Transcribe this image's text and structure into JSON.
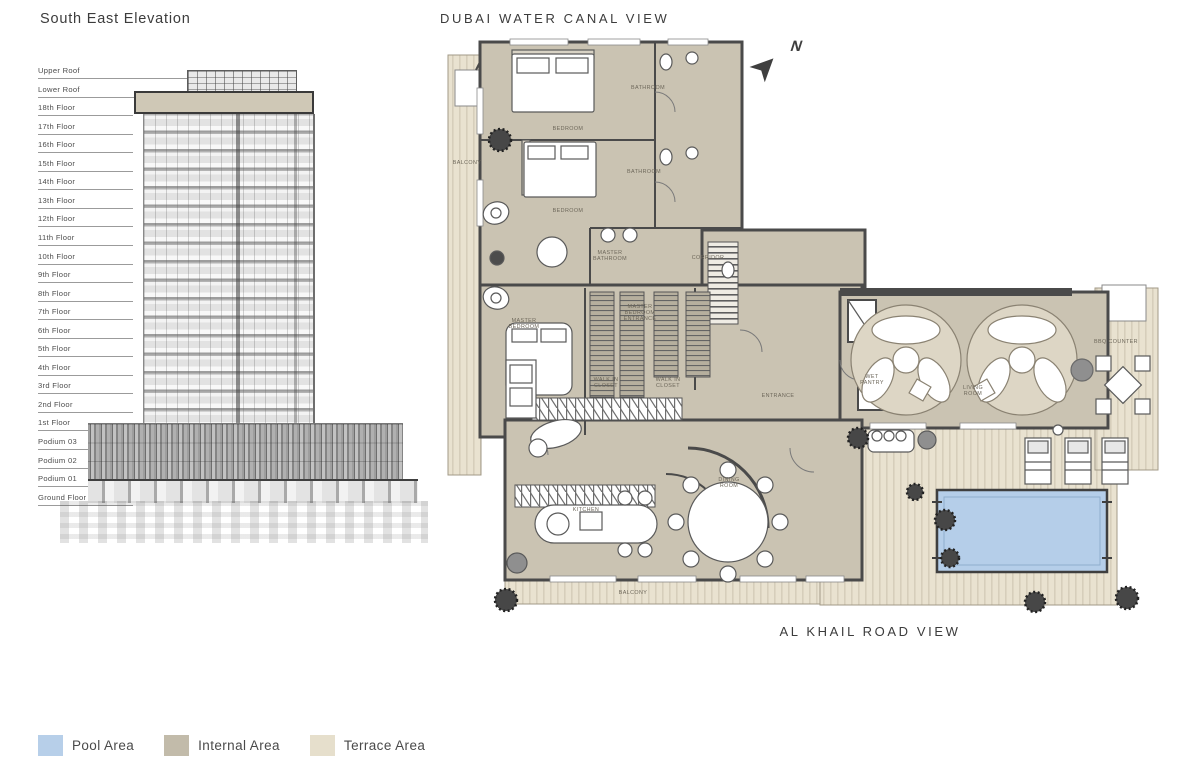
{
  "elevation": {
    "title": "South East Elevation",
    "floors": [
      "Upper Roof",
      "Lower Roof",
      "18th Floor",
      "17th Floor",
      "16th Floor",
      "15th Floor",
      "14th Floor",
      "13th Floor",
      "12th Floor",
      "11th Floor",
      "10th Floor",
      "9th Floor",
      "8th Floor",
      "7th Floor",
      "6th Floor",
      "5th Floor",
      "4th Floor",
      "3rd Floor",
      "2nd Floor",
      "1st Floor",
      "Podium 03",
      "Podium 02",
      "Podium 01",
      "Ground Floor"
    ]
  },
  "plan": {
    "top_view_label": "DUBAI WATER CANAL VIEW",
    "bottom_view_label": "AL KHAIL ROAD VIEW",
    "north_label": "N",
    "rooms": [
      {
        "label": "BALCONY",
        "x": 27,
        "y": 133
      },
      {
        "label": "BEDROOM",
        "x": 128,
        "y": 99
      },
      {
        "label": "BATHROOM",
        "x": 208,
        "y": 58
      },
      {
        "label": "BEDROOM",
        "x": 128,
        "y": 181
      },
      {
        "label": "BATHROOM",
        "x": 204,
        "y": 142
      },
      {
        "label": "MASTER\nBATHROOM",
        "x": 170,
        "y": 226
      },
      {
        "label": "CORRIDOR",
        "x": 268,
        "y": 228
      },
      {
        "label": "MASTER\nBEDROOM",
        "x": 84,
        "y": 294
      },
      {
        "label": "MASTER\nBEDROOM\nENTRANCE",
        "x": 200,
        "y": 283
      },
      {
        "label": "WALK IN\nCLOSET",
        "x": 166,
        "y": 353
      },
      {
        "label": "WALK IN\nCLOSET",
        "x": 228,
        "y": 353
      },
      {
        "label": "ENTRANCE",
        "x": 338,
        "y": 366
      },
      {
        "label": "WET\nPANTRY",
        "x": 432,
        "y": 350
      },
      {
        "label": "LIVING\nROOM",
        "x": 533,
        "y": 361
      },
      {
        "label": "BBQ COUNTER",
        "x": 676,
        "y": 312
      },
      {
        "label": "KITCHEN",
        "x": 146,
        "y": 480
      },
      {
        "label": "DINING\nROOM",
        "x": 289,
        "y": 453
      },
      {
        "label": "BALCONY",
        "x": 193,
        "y": 563
      }
    ]
  },
  "legend": {
    "items": [
      {
        "label": "Pool Area",
        "color": "#b7cfe9"
      },
      {
        "label": "Internal Area",
        "color": "#c2bbaa"
      },
      {
        "label": "Terrace Area",
        "color": "#e6dfcc"
      }
    ]
  },
  "colors": {
    "pool": "#b5cee9",
    "internal": "#cac3b2",
    "terrace": "#eae3d1",
    "terrace_stripe": "#d5cdb9",
    "wall": "#4a4a4a"
  }
}
